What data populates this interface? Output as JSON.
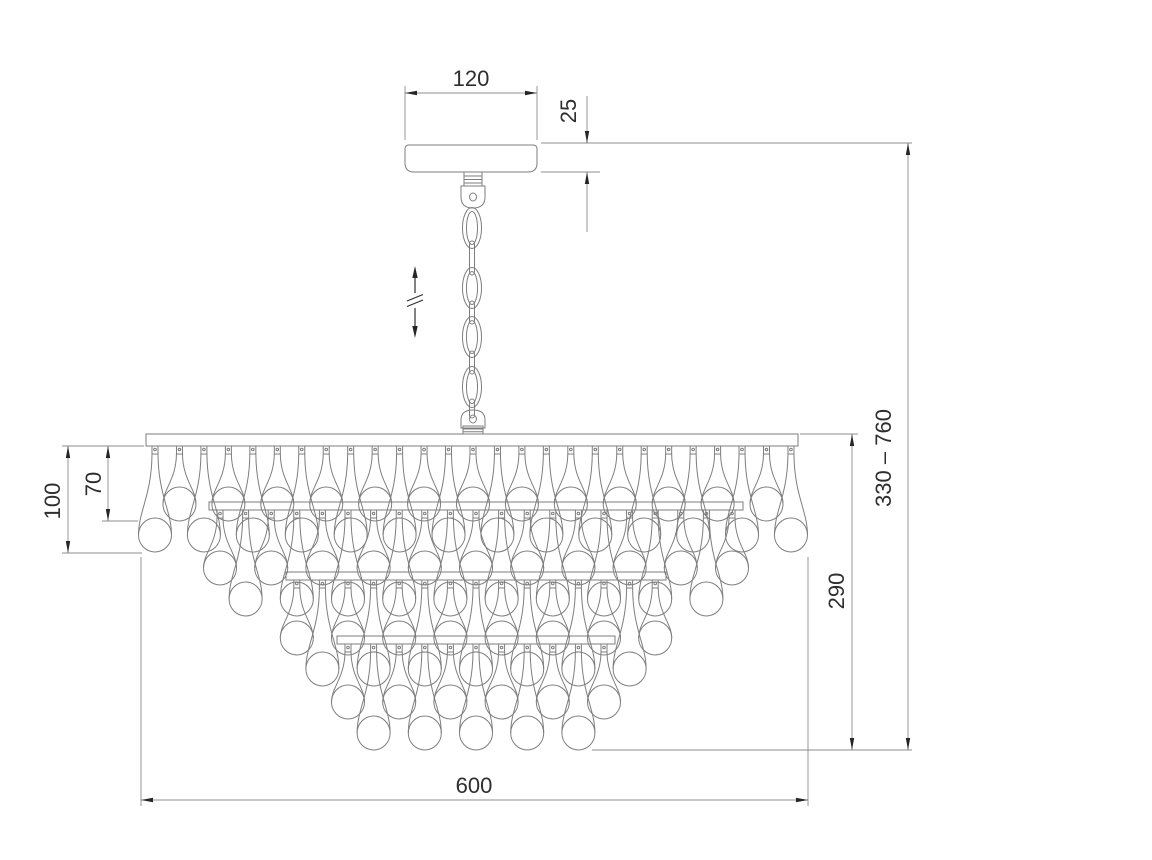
{
  "drawing": {
    "type": "technical_dimension_drawing",
    "subject": "crystal teardrop chandelier with ceiling canopy and adjustable chain suspension",
    "background_color": "#ffffff",
    "line_color": "#7e7e7e",
    "dimension_line_color": "#8c8c8c",
    "arrow_color": "#262626",
    "text_color": "#2e2e2e"
  },
  "dimensions": {
    "canopy_width": {
      "label": "120"
    },
    "canopy_height": {
      "label": "25"
    },
    "short_drop_length": {
      "label": "70"
    },
    "long_drop_length": {
      "label": "100"
    },
    "body_height": {
      "label": "290"
    },
    "total_height_range": {
      "label": "330 – 760"
    },
    "body_width": {
      "label": "600"
    }
  },
  "structure": {
    "chain": {
      "x": 472,
      "oval_link_centers": [
        228,
        288,
        337,
        387
      ],
      "edge_link_spans": [
        [
          241,
          275
        ],
        [
          301,
          324
        ],
        [
          351,
          374
        ],
        [
          399,
          418
        ]
      ]
    },
    "tiers": [
      {
        "count": 27,
        "start_x": 155,
        "spacing": 24.46,
        "first": "long",
        "tab_top": 446,
        "bar": null
      },
      {
        "count": 21,
        "start_x": 220,
        "spacing": 25.6,
        "first": "short",
        "tab_top": 510,
        "bar": {
          "x": 209,
          "y": 502,
          "w": 534
        }
      },
      {
        "count": 15,
        "start_x": 296.8,
        "spacing": 25.6,
        "first": "short",
        "tab_top": 580,
        "bar": {
          "x": 286,
          "y": 572,
          "w": 380
        }
      },
      {
        "count": 11,
        "start_x": 348,
        "spacing": 25.6,
        "first": "short",
        "tab_top": 644,
        "bar": {
          "x": 337,
          "y": 636,
          "w": 278
        }
      }
    ]
  }
}
